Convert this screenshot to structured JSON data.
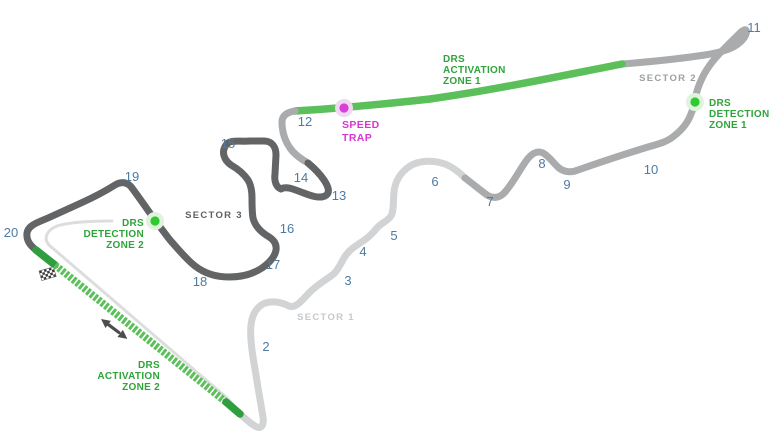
{
  "turns": [
    "2",
    "3",
    "4",
    "5",
    "6",
    "7",
    "8",
    "9",
    "10",
    "11",
    "12",
    "13",
    "14",
    "15",
    "16",
    "17",
    "18",
    "19",
    "20"
  ],
  "sectors": {
    "sector1": "SECTOR 1",
    "sector2": "SECTOR 2",
    "sector3": "SECTOR 3"
  },
  "zones": {
    "drs_activation_1": {
      "lines": [
        "DRS",
        "ACTIVATION",
        "ZONE 1"
      ]
    },
    "drs_detection_1": {
      "lines": [
        "DRS",
        "DETECTION",
        "ZONE 1"
      ]
    },
    "drs_activation_2": {
      "lines": [
        "DRS",
        "ACTIVATION",
        "ZONE 2"
      ]
    },
    "drs_detection_2": {
      "lines": [
        "DRS",
        "DETECTION",
        "ZONE 2"
      ]
    }
  },
  "speed_trap": {
    "lines": [
      "SPEED",
      "TRAP"
    ]
  },
  "icons": {
    "start_finish": "checkered-flag-icon",
    "race_direction": "direction-arrow-icon",
    "drs_detection_marker": "green-dot-marker",
    "speed_trap_marker": "magenta-dot-marker"
  },
  "colors": {
    "sector1_track": "#d2d3d4",
    "sector2_track": "#a9abad",
    "sector3_track": "#636466",
    "drs_green": "#5bc05a",
    "drs_dark_green": "#2e9e3e",
    "pit_lane_gray": "#dcdddd",
    "turn_number_blue": "#4c7ba3",
    "drs_label_green": "#2fa43b",
    "speed_trap_magenta": "#d936d0",
    "detection_dot_green": "#30c930",
    "detection_halo": "#dff3dd",
    "speed_trap_dot": "#d83ed8",
    "speed_trap_halo": "#f0d8f0",
    "sector1_label_gray": "#c5c9cc",
    "sector2_label_gray": "#9ba0a3",
    "sector3_label_gray": "#5e6164",
    "arrow_gray": "#4d4d4d",
    "background": "#ffffff"
  }
}
